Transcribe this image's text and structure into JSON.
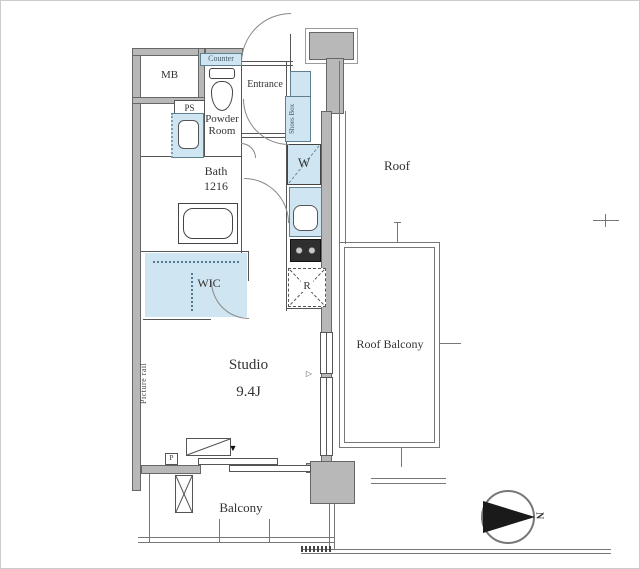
{
  "plan": {
    "title": "studio-apartment-floor-plan",
    "labels": {
      "mb": "MB",
      "ps": "PS",
      "counter": "Counter",
      "entrance": "Entrance",
      "shoes_box": "Shoes Box",
      "powder_room": "Powder Room",
      "bath": "Bath",
      "bath_size": "1216",
      "washer": "W",
      "wic": "WIC",
      "fridge": "R",
      "studio": "Studio",
      "studio_size": "9.4J",
      "picture_rail": "Picture rail",
      "pipe_shaft": "P",
      "roof": "Roof",
      "roof_balcony": "Roof Balcony",
      "balcony": "Balcony",
      "north": "N"
    },
    "markers": {
      "window_joint": "▼",
      "opening_pointer": "▷"
    },
    "colors": {
      "wall_fill": "#b8b8b8",
      "wall_outline": "#666666",
      "thin_line": "#555555",
      "fixture_fill": "#cfe5f1",
      "fixture_border": "#5e7f90",
      "text": "#333333",
      "compass_needle": "#1a1a1a"
    }
  }
}
